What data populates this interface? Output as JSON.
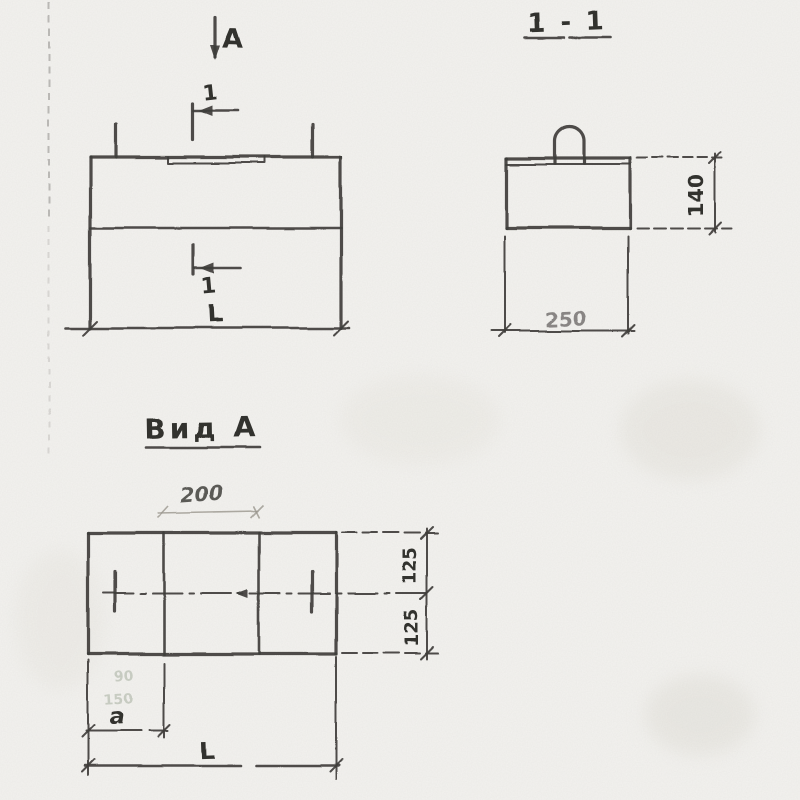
{
  "meta": {
    "kind": "scanned pencil engineering drawing",
    "background_color": "#f3f2ef",
    "ink_color": "#3f3e3b",
    "pencil_color": "#9a968e"
  },
  "front_view": {
    "view_direction_label": "A",
    "section_cut_top_label": "1",
    "section_cut_bottom_label": "1",
    "letter_below_cut": "L"
  },
  "section_view": {
    "title": "1 - 1",
    "dim_height": "140",
    "dim_width": "250"
  },
  "plan_view": {
    "title": "Вид А",
    "dim_mid_panel": "200",
    "dim_half_upper": "125",
    "dim_half_lower": "125",
    "dim_offset": "a",
    "dim_total_length": "L",
    "faint_mark_upper": "90",
    "faint_mark_lower": "150"
  }
}
